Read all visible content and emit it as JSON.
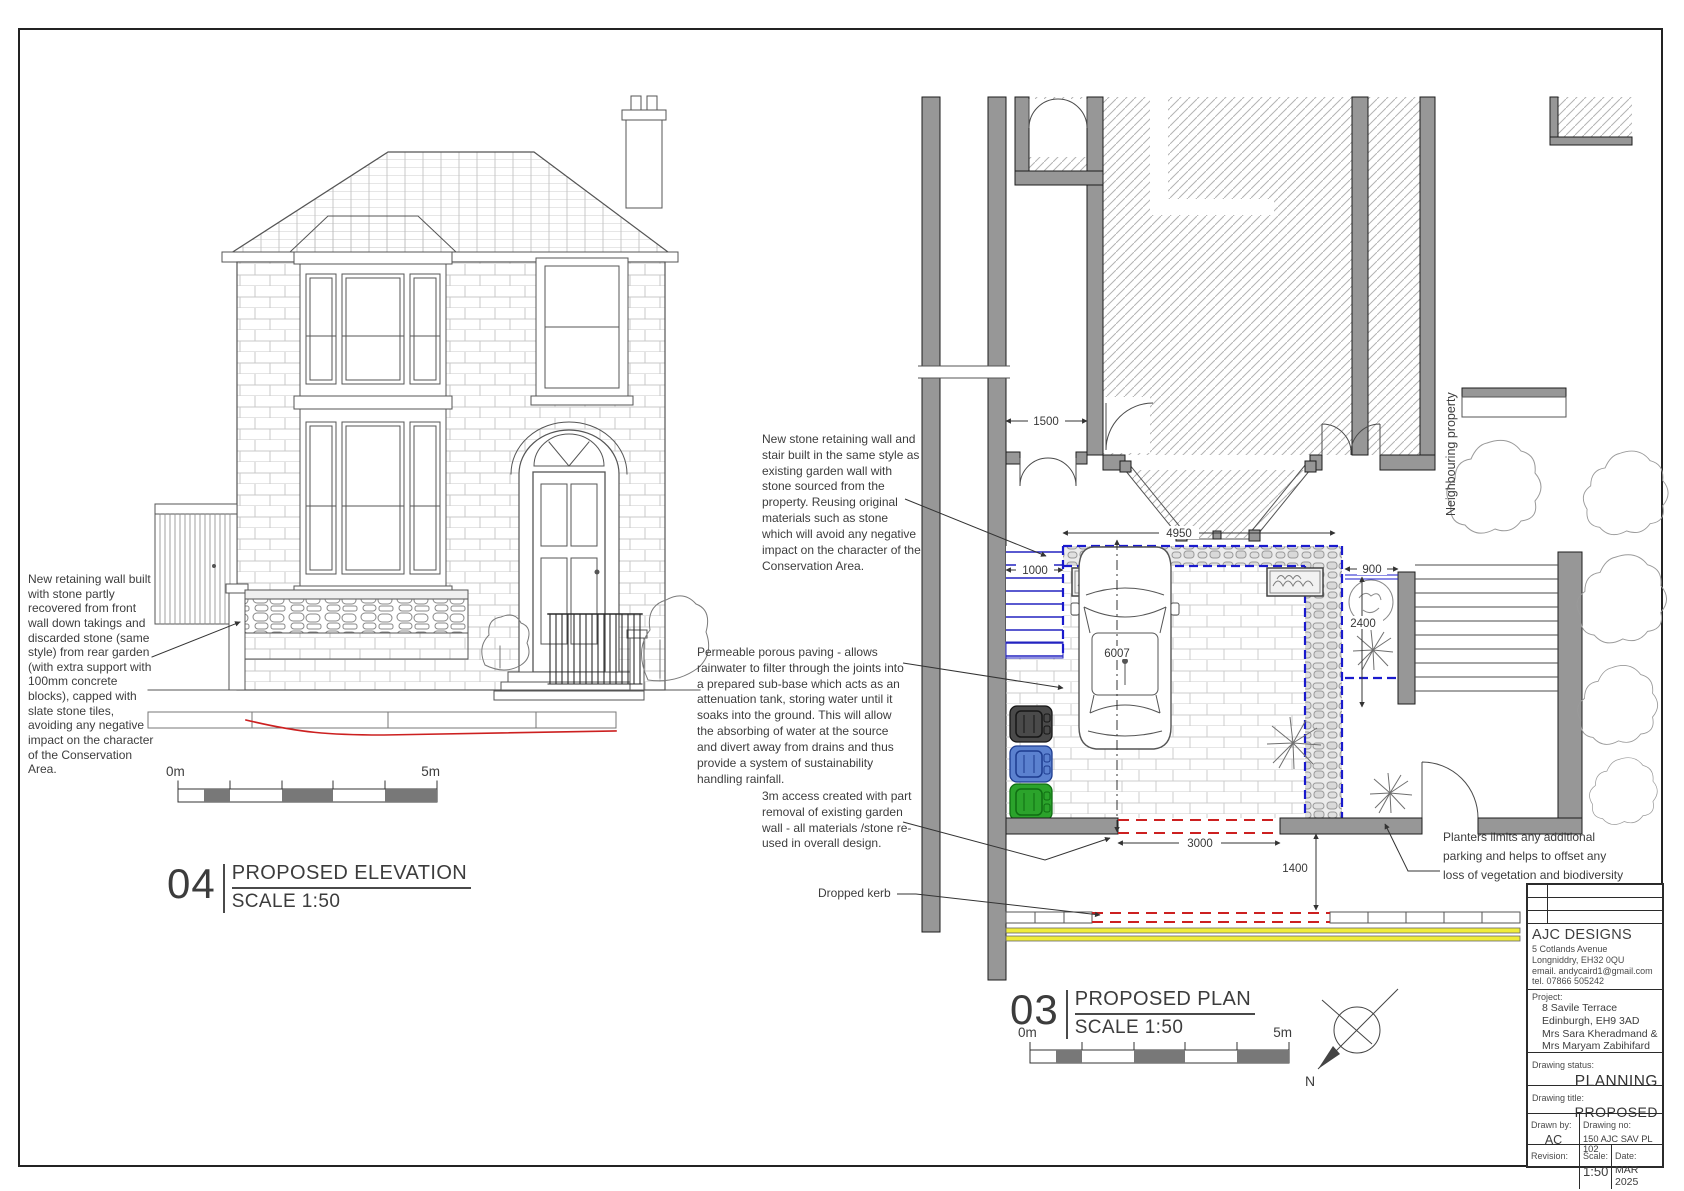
{
  "colors": {
    "new_work_blue": "#1a1acd",
    "demolition_red": "#cc2020",
    "road_marking_yellow": "#f0ec3a",
    "wall_grey": "#979797"
  },
  "elevation": {
    "number": "04",
    "title": "PROPOSED ELEVATION",
    "scale_label": "SCALE 1:50",
    "annotation_retaining_wall": "New retaining wall built with stone partly recovered from front wall down takings and discarded stone (same style) from rear garden (with extra support with 100mm concrete blocks), capped with slate stone tiles, avoiding any negative impact on the character of the Conservation Area.",
    "scale_bar": {
      "start": "0m",
      "end": "5m"
    }
  },
  "plan": {
    "number": "03",
    "title": "PROPOSED PLAN",
    "scale_label": "SCALE 1:50",
    "north_label": "N",
    "scale_bar": {
      "start": "0m",
      "end": "5m"
    },
    "annotations": {
      "retaining_wall": "New stone retaining wall and stair built in the same style as existing garden wall with stone sourced from the property. Reusing original materials such as stone which will avoid any negative impact on the character of the Conservation Area.",
      "paving": "Permeable porous paving - allows rainwater to filter through the joints into a prepared sub-base which acts as an attenuation tank, storing water until it soaks into the ground. This will allow the absorbing of water at the source and divert away from drains and thus provide a system of sustainability handling rainfall.",
      "access": "3m access created with part removal of existing garden wall - all materials /stone re-used in overall design.",
      "dropped_kerb": "Dropped kerb",
      "planters": "Planters limits any additional parking and helps to offset any loss of vegetation and biodiversity",
      "neighbouring_property": "Neighbouring property"
    },
    "dimensions": {
      "side_path": "1500",
      "garden_width": "4950",
      "stair_width": "1000",
      "planting_strip_width": "900",
      "planting_strip_depth": "2400",
      "garden_depth": "6007",
      "access_width": "3000",
      "pavement_depth": "1400"
    }
  },
  "title_block": {
    "company": "AJC DESIGNS",
    "address_line1": "5 Cotlands Avenue",
    "address_line2": "Longniddry, EH32 0QU",
    "email": "email. andycaird1@gmail.com",
    "tel": "tel. 07866 505242",
    "project_label": "Project:",
    "project_lines": [
      "8 Savile Terrace",
      "Edinburgh, EH9 3AD",
      "Mrs Sara Kheradmand &",
      "Mrs Maryam Zabihifard"
    ],
    "status_label": "Drawing status:",
    "status_value": "PLANNING",
    "title_label": "Drawing title:",
    "title_value": "PROPOSED",
    "drawn_by_label": "Drawn by:",
    "drawn_by_value": "AC",
    "drawing_no_label": "Drawing no:",
    "drawing_no_value": "150 AJC SAV PL 102",
    "revision_label": "Revision:",
    "revision_value": "",
    "scale_label": "Scale:",
    "scale_value": "1:50",
    "date_label": "Date:",
    "date_value": "MAR 2025"
  }
}
